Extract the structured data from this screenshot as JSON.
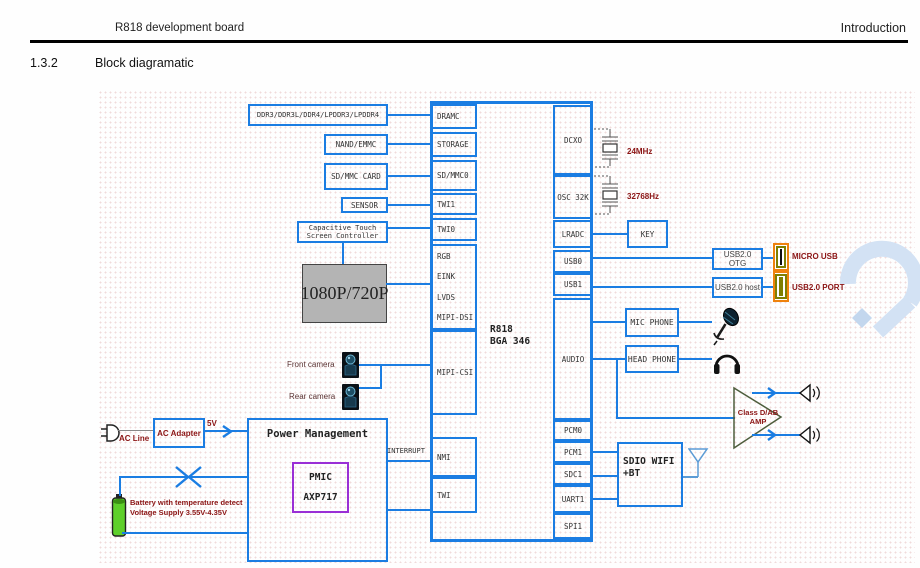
{
  "header": {
    "left": "R818 development board",
    "right": "Introduction"
  },
  "section": {
    "number": "1.3.2",
    "title": "Block diagramatic"
  },
  "peripherals": {
    "ddr": "DDR3/DDR3L/DDR4/LPDDR3/LPDDR4",
    "nand": "NAND/EMMC",
    "sd_card": "SD/MMC CARD",
    "sensor": "SENSOR",
    "touch_line1": "Capacitive Touch",
    "touch_line2": "Screen Controller",
    "display": "1080P/720P",
    "front_camera": "Front camera",
    "rear_camera": "Rear camera"
  },
  "chip": {
    "name_line1": "R818",
    "name_line2": "BGA 346",
    "left_ports": [
      "DRAMC",
      "STORAGE",
      "SD/MMC0",
      "TWI1",
      "TWI0",
      "RGB",
      "EINK",
      "LVDS",
      "MIPI-DSI",
      "MIPI-CSI",
      "NMI",
      "TWI"
    ],
    "right_ports": [
      "DCXO",
      "OSC 32K",
      "LRADC",
      "USB0",
      "USB1",
      "AUDIO",
      "PCM0",
      "PCM1",
      "SDC1",
      "UART1",
      "SPI1"
    ]
  },
  "clocks": {
    "crystal_24mhz": "24MHz",
    "crystal_32k": "32768Hz"
  },
  "right_side": {
    "key": "KEY",
    "usb_otg": "USB2.0 OTG",
    "usb_host": "USB2.0 host",
    "micro_usb": "MICRO USB",
    "usb_port": "USB2.0 PORT",
    "mic_phone": "MIC PHONE",
    "head_phone": "HEAD PHONE",
    "amp_line1": "Class D/AB",
    "amp_line2": "AMP",
    "sdio_line1": "SDIO WIFI",
    "sdio_line2": "+BT"
  },
  "power": {
    "ac_line": "AC Line",
    "ac_adapter": "AC Adapter",
    "rail_5v": "5V",
    "pm_title": "Power Management",
    "pmic_line1": "PMIC",
    "pmic_line2": "AXP717",
    "interrupt": "INTERRUPT",
    "battery_line1": "Battery with temperature detect",
    "battery_line2": "Voltage Supply 3.55V-4.35V"
  },
  "colors": {
    "line_blue": "#1b7de2",
    "label_red": "#8b1414",
    "orange": "#ef820d",
    "purple": "#9a2fd6",
    "display_gray": "#b4b4b4",
    "battery_green": "#5ecf2b",
    "olive": "#7f7f00",
    "watermark_blue": "#d3e2f4"
  }
}
